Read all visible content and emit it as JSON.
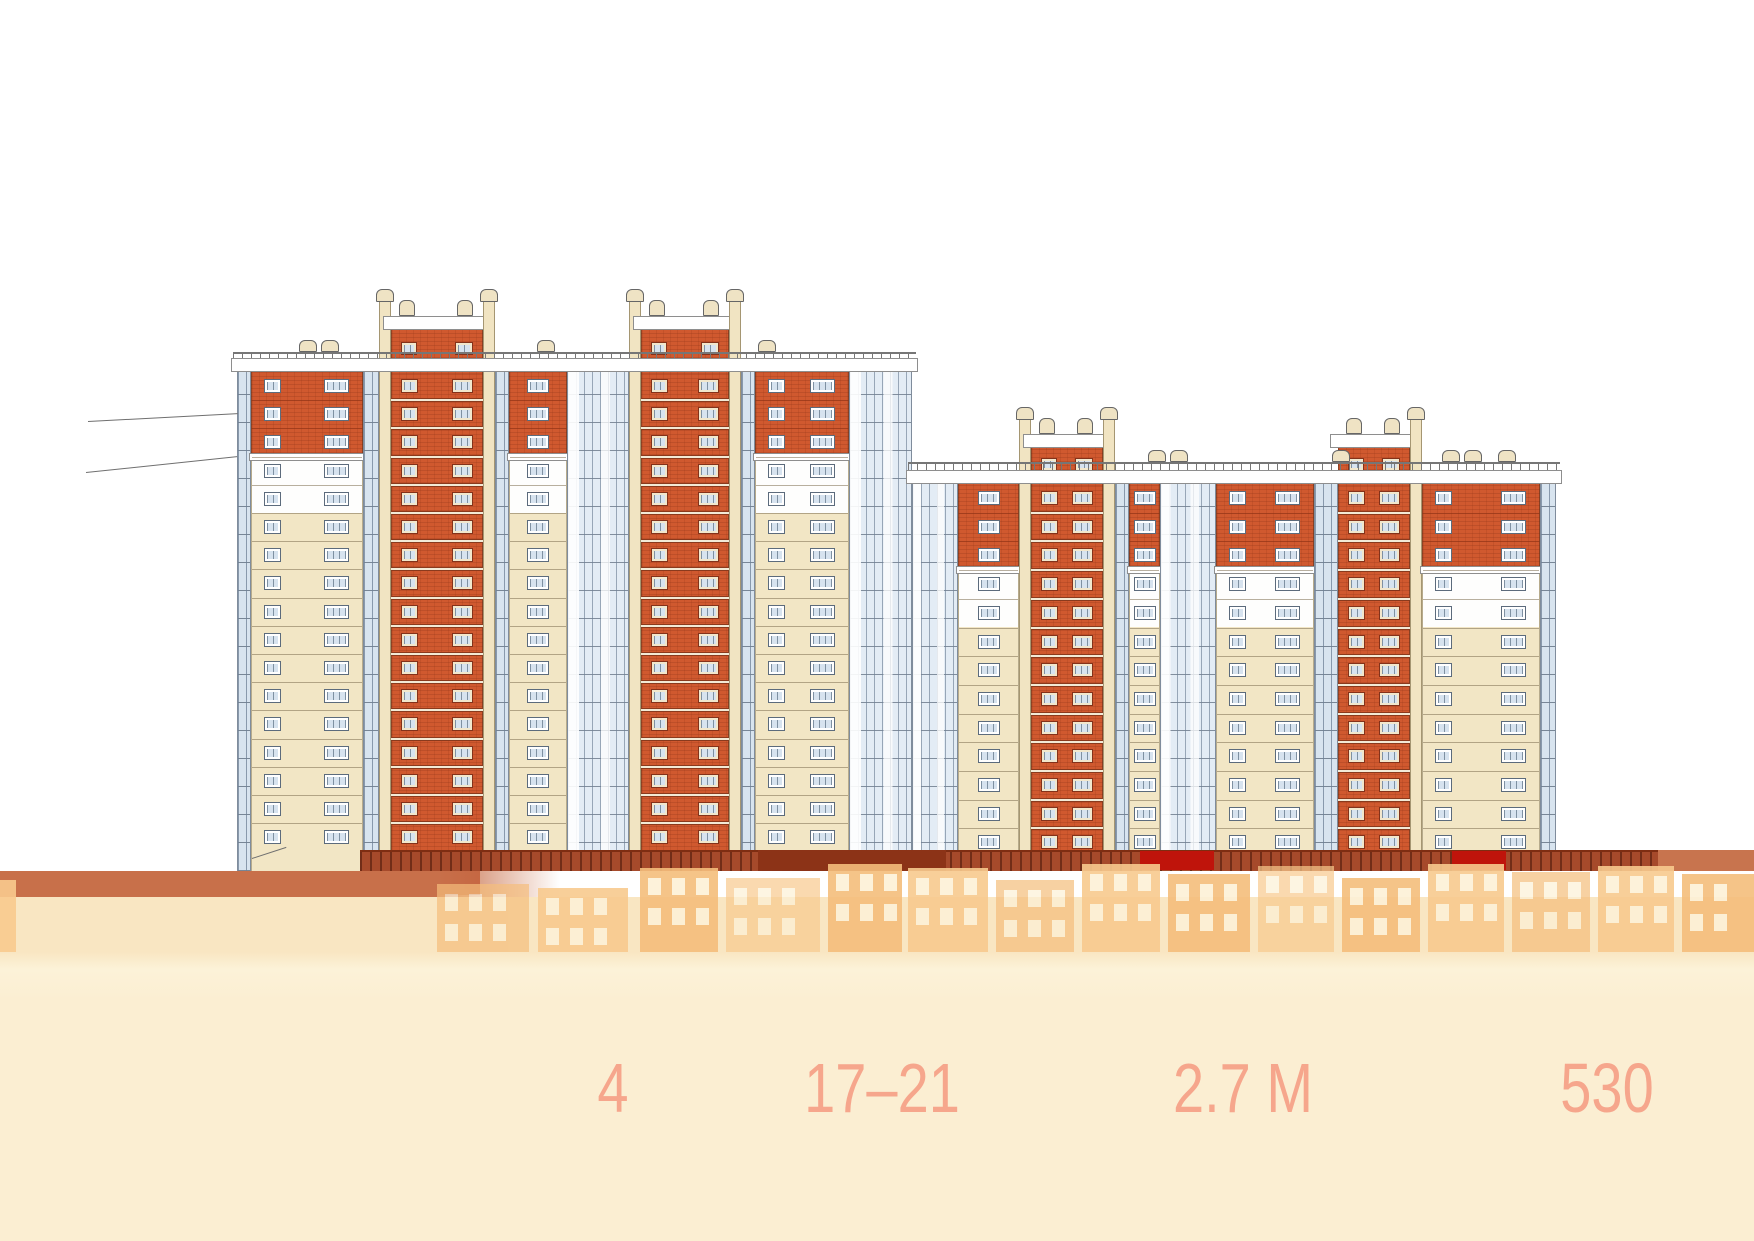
{
  "page": {
    "background": "#ffffff",
    "description_colors": {
      "band": "#c8704a",
      "overlay_cream": "#fbeed2",
      "stat_text": "#f6a68c"
    }
  },
  "stats": {
    "color": "#f6a68c",
    "top_y": 1053,
    "items": [
      {
        "value": "4",
        "x": 613
      },
      {
        "value": "17–21",
        "x": 882
      },
      {
        "value": "2.7 М",
        "x": 1243
      },
      {
        "value": "530",
        "x": 1607
      }
    ]
  },
  "facade": {
    "groundY": 871,
    "buildings": [
      {
        "name": "building-left",
        "x": 237,
        "w": 675,
        "railY": 352,
        "parapetY": 358,
        "parapetH": 14,
        "floorsTop": 372,
        "floorH": 28.2,
        "brickFloors": 3,
        "whiteFloors": 2,
        "boxVentY": 300,
        "boxCapY": 316,
        "boxBrickY": 330,
        "boxWinY": 342,
        "pilTopY": 302,
        "strips": [
          [
            0,
            14,
            "glz"
          ],
          [
            14,
            126,
            "wall2"
          ],
          [
            126,
            142,
            "glz"
          ],
          [
            142,
            154,
            "pil"
          ],
          [
            154,
            246,
            "tower"
          ],
          [
            246,
            258,
            "pil"
          ],
          [
            258,
            272,
            "glz"
          ],
          [
            272,
            330,
            "wall1"
          ],
          [
            330,
            392,
            "glzW"
          ],
          [
            392,
            404,
            "pil"
          ],
          [
            404,
            492,
            "tower"
          ],
          [
            492,
            504,
            "pil"
          ],
          [
            504,
            518,
            "glz"
          ],
          [
            518,
            612,
            "wall2"
          ],
          [
            612,
            675,
            "glzW"
          ]
        ],
        "roofVents": [
          62,
          84,
          300,
          521
        ]
      },
      {
        "name": "building-right",
        "x": 912,
        "w": 644,
        "railY": 462,
        "parapetY": 470,
        "parapetH": 14,
        "floorsTop": 484,
        "floorH": 28.7,
        "brickFloors": 3,
        "whiteFloors": 2,
        "boxVentY": 418,
        "boxCapY": 434,
        "boxBrickY": 448,
        "boxWinY": 458,
        "pilTopY": 420,
        "strips": [
          [
            0,
            46,
            "glzW"
          ],
          [
            46,
            107,
            "wall1"
          ],
          [
            107,
            119,
            "pil"
          ],
          [
            119,
            191,
            "tower"
          ],
          [
            191,
            203,
            "pil"
          ],
          [
            203,
            217,
            "glz"
          ],
          [
            217,
            248,
            "wall1"
          ],
          [
            248,
            304,
            "glzW"
          ],
          [
            304,
            402,
            "wall2"
          ],
          [
            402,
            426,
            "glz"
          ],
          [
            426,
            498,
            "tower"
          ],
          [
            498,
            510,
            "pil"
          ],
          [
            510,
            628,
            "wall2"
          ],
          [
            628,
            644,
            "glz"
          ]
        ],
        "roofVents": [
          236,
          258,
          420,
          530,
          552,
          586
        ]
      }
    ],
    "leaders": [
      {
        "x": 88,
        "y": 421,
        "w": 150,
        "rot": -3
      },
      {
        "x": 86,
        "y": 472,
        "w": 152,
        "rot": -6
      },
      {
        "x": 252,
        "y": 858,
        "w": 36,
        "rot": -18
      }
    ],
    "ground": {
      "clutter": {
        "x": 360,
        "w": 1298,
        "y": 850,
        "h": 21
      },
      "blocks": [
        {
          "x": 758,
          "w": 188,
          "y": 850,
          "h": 21,
          "color": "#8c3317"
        },
        {
          "x": 1140,
          "w": 74,
          "y": 851,
          "h": 19,
          "color": "#bf140b"
        },
        {
          "x": 1452,
          "w": 54,
          "y": 851,
          "h": 19,
          "color": "#bf140b"
        },
        {
          "x": 1658,
          "w": 96,
          "y": 850,
          "h": 21,
          "color": "#c8744e"
        },
        {
          "x": 367,
          "w": 58,
          "y": 871,
          "h": 24,
          "color": "#93351b"
        },
        {
          "x": 428,
          "w": 52,
          "y": 871,
          "h": 24,
          "color": "#c25835"
        }
      ],
      "band": {
        "x": 0,
        "w": 560,
        "y": 871,
        "h": 26,
        "color": "#c8704a",
        "fadeFrom": 0.78
      }
    },
    "overlay": {
      "y": 897,
      "h": 344,
      "gradient": [
        "#f9e6c2 0%",
        "#f9e6c2 16%",
        "#fcf2d8 21%",
        "#fbeed2 30%",
        "#fbeed2 100%"
      ]
    },
    "houses": {
      "bottom": 952,
      "wallColors": [
        "#f8ca8e",
        "#f5be7c"
      ],
      "windowColor": "#fdf1d6",
      "blocks": [
        {
          "x": 0,
          "w": 16,
          "top": 880
        },
        {
          "x": 437,
          "w": 92,
          "top": 884
        },
        {
          "x": 538,
          "w": 90,
          "top": 888
        },
        {
          "x": 640,
          "w": 78,
          "top": 868
        },
        {
          "x": 726,
          "w": 94,
          "top": 878
        },
        {
          "x": 828,
          "w": 74,
          "top": 864
        },
        {
          "x": 908,
          "w": 80,
          "top": 868
        },
        {
          "x": 996,
          "w": 78,
          "top": 880
        },
        {
          "x": 1082,
          "w": 78,
          "top": 864
        },
        {
          "x": 1168,
          "w": 82,
          "top": 874
        },
        {
          "x": 1258,
          "w": 76,
          "top": 866
        },
        {
          "x": 1342,
          "w": 78,
          "top": 878
        },
        {
          "x": 1428,
          "w": 76,
          "top": 864
        },
        {
          "x": 1512,
          "w": 78,
          "top": 872
        },
        {
          "x": 1598,
          "w": 76,
          "top": 866
        },
        {
          "x": 1682,
          "w": 72,
          "top": 874
        }
      ]
    }
  }
}
